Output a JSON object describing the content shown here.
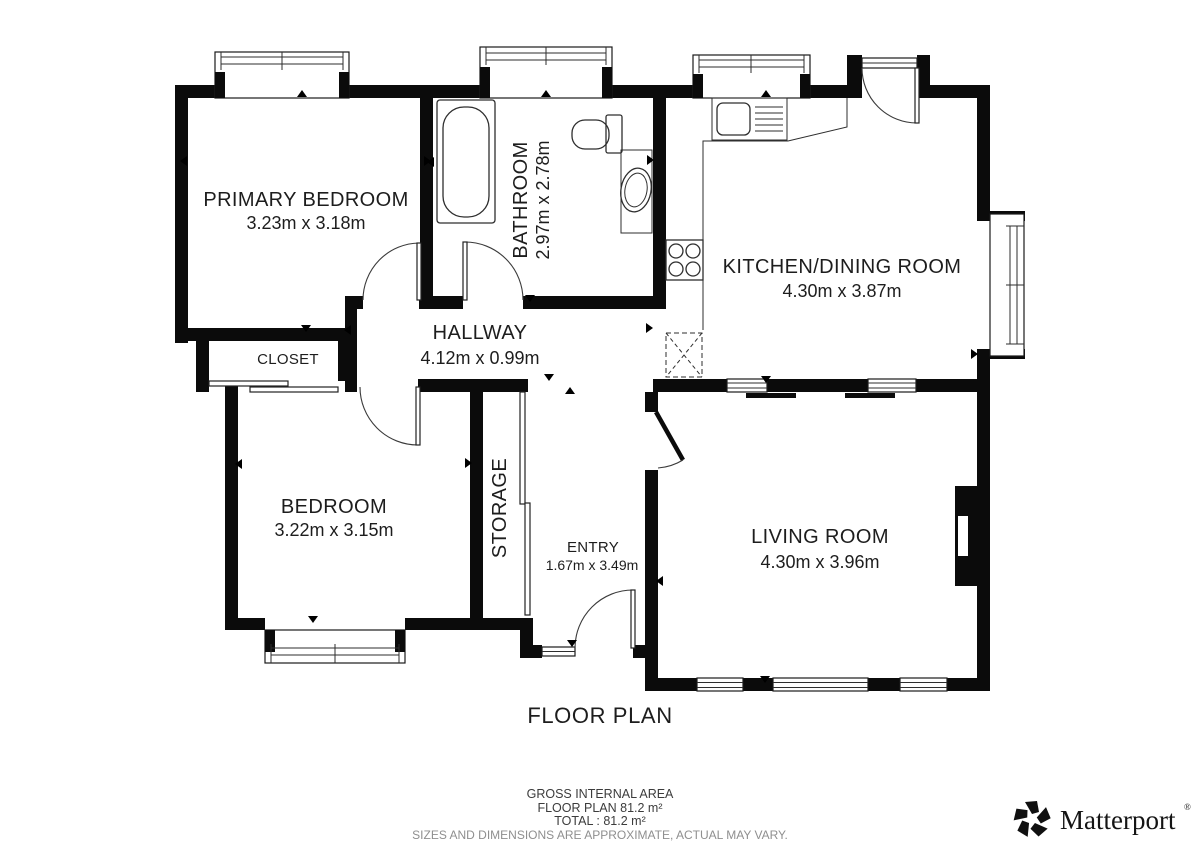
{
  "title": "FLOOR PLAN",
  "rooms": [
    {
      "name": "PRIMARY BEDROOM",
      "dims": "3.23m x 3.18m"
    },
    {
      "name": "BATHROOM",
      "dims": "2.97m x 2.78m"
    },
    {
      "name": "KITCHEN/DINING ROOM",
      "dims": "4.30m x 3.87m"
    },
    {
      "name": "CLOSET",
      "dims": ""
    },
    {
      "name": "HALLWAY",
      "dims": "4.12m x 0.99m"
    },
    {
      "name": "BEDROOM",
      "dims": "3.22m x 3.15m"
    },
    {
      "name": "STORAGE",
      "dims": ""
    },
    {
      "name": "ENTRY",
      "dims": "1.67m x 3.49m"
    },
    {
      "name": "LIVING ROOM",
      "dims": "4.30m x 3.96m"
    }
  ],
  "footer": {
    "gross_internal_area": "GROSS INTERNAL AREA",
    "floor_plan_area": "FLOOR PLAN 81.2 m²",
    "total": "TOTAL :  81.2 m²",
    "disclaimer": "SIZES AND DIMENSIONS ARE APPROXIMATE, ACTUAL MAY VARY."
  },
  "brand": {
    "name": "Matterport",
    "registered": "®"
  },
  "colors": {
    "wall": "#0b0b0b",
    "background": "#ffffff",
    "footer_gray": "#8f8f8f"
  }
}
